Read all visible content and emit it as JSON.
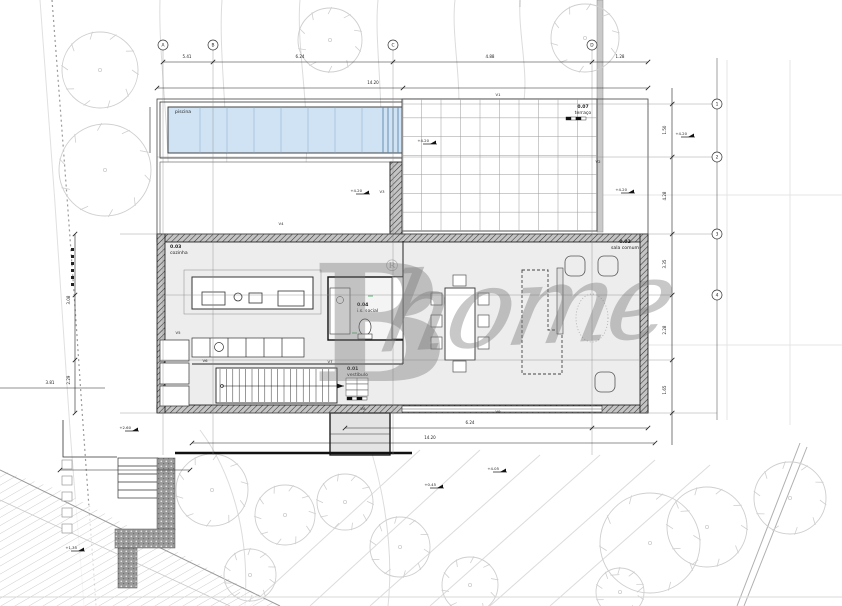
{
  "watermark": {
    "b": "B",
    "reg": "®",
    "script": "home"
  },
  "rooms": {
    "pool": {
      "name": "piscina"
    },
    "terrace": {
      "number": "0.07",
      "name": "terraço"
    },
    "kitchen": {
      "number": "0.03",
      "name": "cozinha"
    },
    "wc": {
      "number": "0.04",
      "name": "i.s. social"
    },
    "hall": {
      "number": "0.01",
      "name": "vestíbulo"
    },
    "living": {
      "number": "0.02",
      "name": "sala comum"
    }
  },
  "grid": {
    "top": [
      {
        "label": "A",
        "x": 163
      },
      {
        "label": "B",
        "x": 213
      },
      {
        "label": "C",
        "x": 393
      },
      {
        "label": "D",
        "x": 592
      }
    ],
    "right": [
      {
        "label": "1",
        "y": 104
      },
      {
        "label": "2",
        "y": 157
      },
      {
        "label": "3",
        "y": 234
      },
      {
        "label": "4",
        "y": 295
      }
    ]
  },
  "dimensions": {
    "top": [
      {
        "x": 187,
        "y": 58,
        "t": "5.41"
      },
      {
        "x": 300,
        "y": 58,
        "t": "6.24"
      },
      {
        "x": 490,
        "y": 58,
        "t": "4.88"
      },
      {
        "x": 620,
        "y": 58,
        "t": "1.28"
      }
    ],
    "top_total": {
      "x": 373,
      "y": 84,
      "t": "14.20"
    },
    "bottom": [
      {
        "x": 470,
        "y": 424,
        "t": "6.24"
      }
    ],
    "bottom_total": {
      "x": 430,
      "y": 439,
      "t": "14.20"
    },
    "right": [
      {
        "x": 666,
        "y": 130,
        "t": "1.50"
      },
      {
        "x": 666,
        "y": 196,
        "t": "4.28"
      },
      {
        "x": 666,
        "y": 264,
        "t": "3.35"
      },
      {
        "x": 666,
        "y": 330,
        "t": "2.28"
      },
      {
        "x": 666,
        "y": 390,
        "t": "1.65"
      }
    ],
    "left": [
      {
        "x": 70,
        "y": 300,
        "t": "3.08"
      },
      {
        "x": 70,
        "y": 380,
        "t": "2.29"
      }
    ],
    "misc": [
      {
        "x": 50,
        "y": 384,
        "t": "3.81"
      }
    ]
  },
  "spot_levels": [
    {
      "x": 430,
      "y": 144,
      "t": "+4.20"
    },
    {
      "x": 363,
      "y": 194,
      "t": "+4.20"
    },
    {
      "x": 628,
      "y": 193,
      "t": "+4.20"
    },
    {
      "x": 688,
      "y": 137,
      "t": "+4.20"
    },
    {
      "x": 500,
      "y": 472,
      "t": "+4.05"
    },
    {
      "x": 132,
      "y": 431,
      "t": "+2.60"
    },
    {
      "x": 78,
      "y": 551,
      "t": "+1.35"
    },
    {
      "x": 437,
      "y": 488,
      "t": "+0.45"
    }
  ],
  "red_marks": [
    {
      "x": 498,
      "y": 96,
      "t": "V1"
    },
    {
      "x": 598,
      "y": 163,
      "t": "V2"
    },
    {
      "x": 382,
      "y": 193,
      "t": "V3"
    },
    {
      "x": 281,
      "y": 225,
      "t": "V4"
    },
    {
      "x": 178,
      "y": 334,
      "t": "V5"
    },
    {
      "x": 205,
      "y": 362,
      "t": "V6"
    },
    {
      "x": 330,
      "y": 363,
      "t": "V7"
    },
    {
      "x": 363,
      "y": 410,
      "t": "V8"
    },
    {
      "x": 498,
      "y": 413,
      "t": "V9"
    }
  ],
  "site": {
    "trees": [
      {
        "x": 100,
        "y": 70,
        "r": 38
      },
      {
        "x": 105,
        "y": 170,
        "r": 46
      },
      {
        "x": 330,
        "y": 40,
        "r": 32
      },
      {
        "x": 585,
        "y": 38,
        "r": 34
      },
      {
        "x": 185,
        "y": 188,
        "r": 24
      },
      {
        "x": 243,
        "y": 196,
        "r": 22
      },
      {
        "x": 300,
        "y": 192,
        "r": 25
      },
      {
        "x": 350,
        "y": 193,
        "r": 22
      },
      {
        "x": 212,
        "y": 490,
        "r": 36
      },
      {
        "x": 285,
        "y": 515,
        "r": 30
      },
      {
        "x": 345,
        "y": 502,
        "r": 28
      },
      {
        "x": 400,
        "y": 547,
        "r": 30
      },
      {
        "x": 250,
        "y": 575,
        "r": 26
      },
      {
        "x": 470,
        "y": 585,
        "r": 28
      },
      {
        "x": 650,
        "y": 543,
        "r": 50
      },
      {
        "x": 707,
        "y": 527,
        "r": 40
      },
      {
        "x": 790,
        "y": 498,
        "r": 36
      },
      {
        "x": 620,
        "y": 592,
        "r": 24
      }
    ]
  },
  "stairs": {
    "treads": 18
  },
  "deck": {
    "cols": 10,
    "rows": 7
  },
  "pool": {
    "lanes": 7
  },
  "scale_bars": [
    {
      "x": 566,
      "y": 117
    },
    {
      "x": 347,
      "y": 397
    }
  ],
  "colors": {
    "pool_fill": "#cfe3f4",
    "floor": "#ededed",
    "tree": "#cfcfcf",
    "red": "#c1272d",
    "green": "#3fa45a",
    "walkway": "#9a9a9a"
  }
}
